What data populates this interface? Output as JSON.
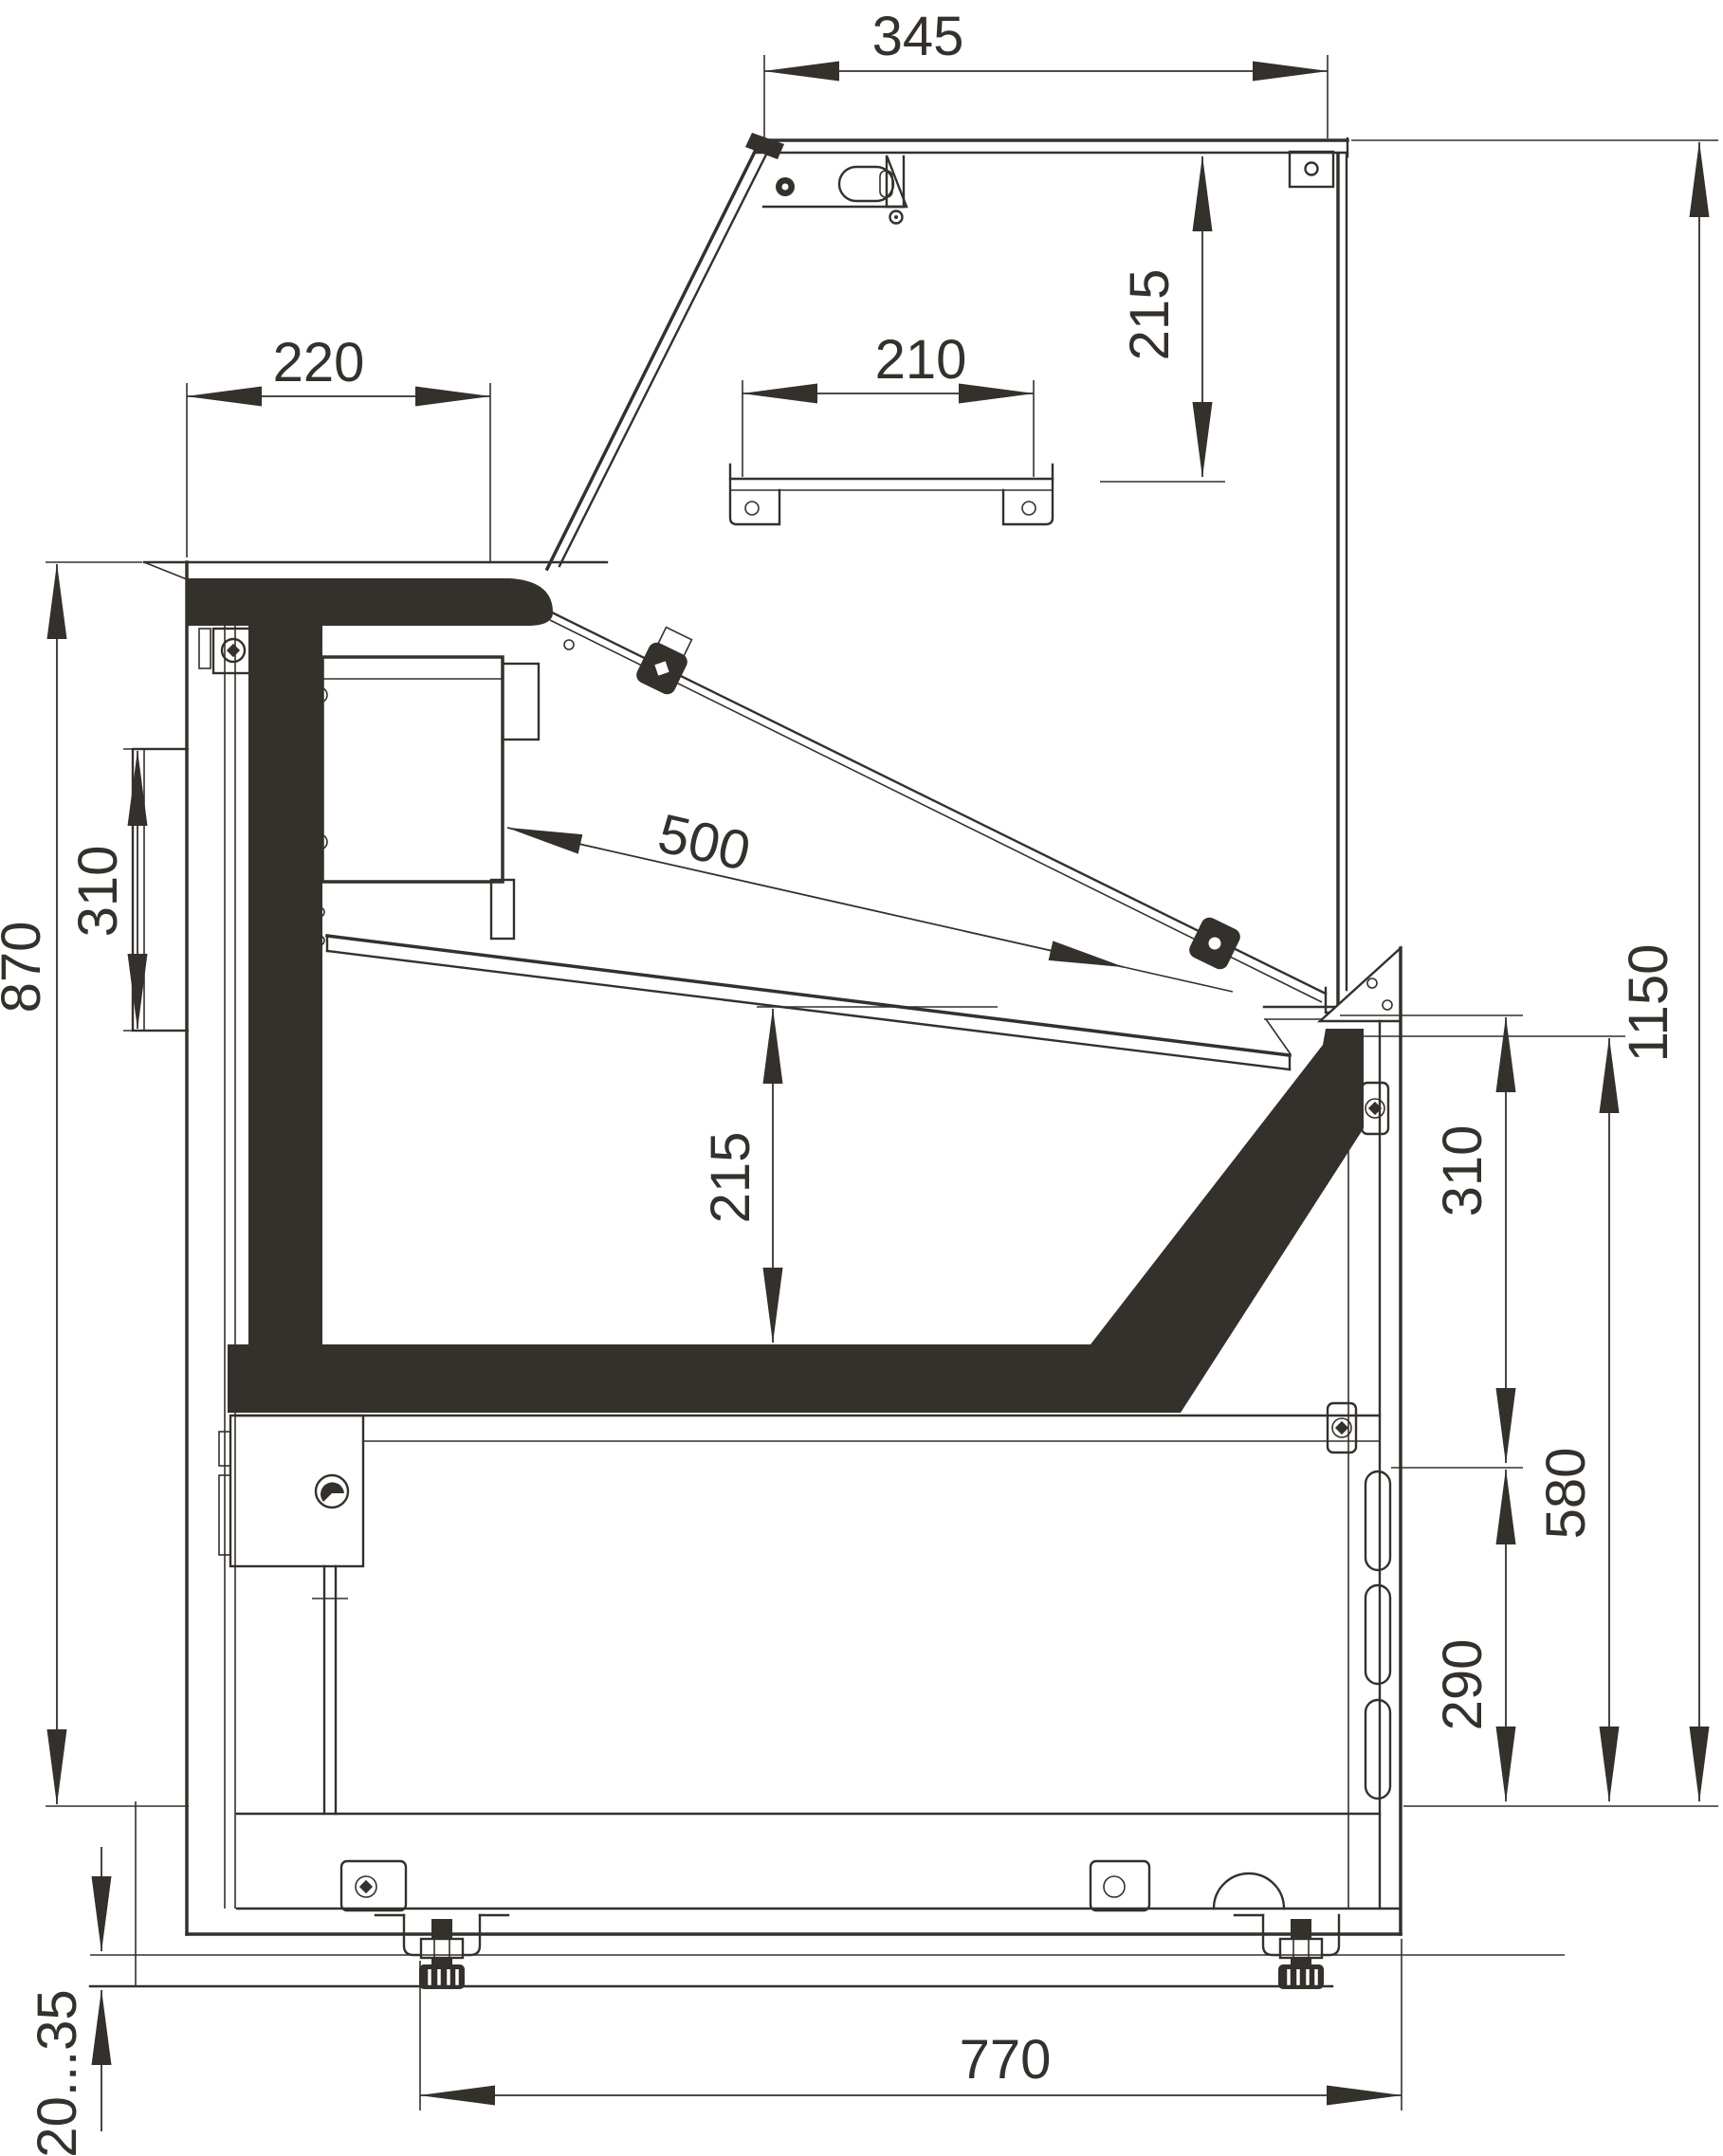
{
  "drawing": {
    "name": "refrigerated-serve-over-counter-side-section",
    "background_color": "#ffffff",
    "line_color": "#34302c",
    "dims": {
      "top_width": {
        "label": "345"
      },
      "upper_glass_to_shelf": {
        "label": "215"
      },
      "canopy_depth": {
        "label": "220"
      },
      "shelf_depth": {
        "label": "210"
      },
      "display_deck_depth": {
        "label": "500"
      },
      "rear_panel_height": {
        "label": "310"
      },
      "rear_body_height": {
        "label": "870"
      },
      "chamber_height": {
        "label": "215"
      },
      "overall_height": {
        "label": "1150"
      },
      "front_upper_height": {
        "label": "310"
      },
      "front_lower_height": {
        "label": "580"
      },
      "louver_height": {
        "label": "290"
      },
      "foot_adjustment": {
        "label": "20...35"
      },
      "base_depth": {
        "label": "770"
      }
    }
  }
}
